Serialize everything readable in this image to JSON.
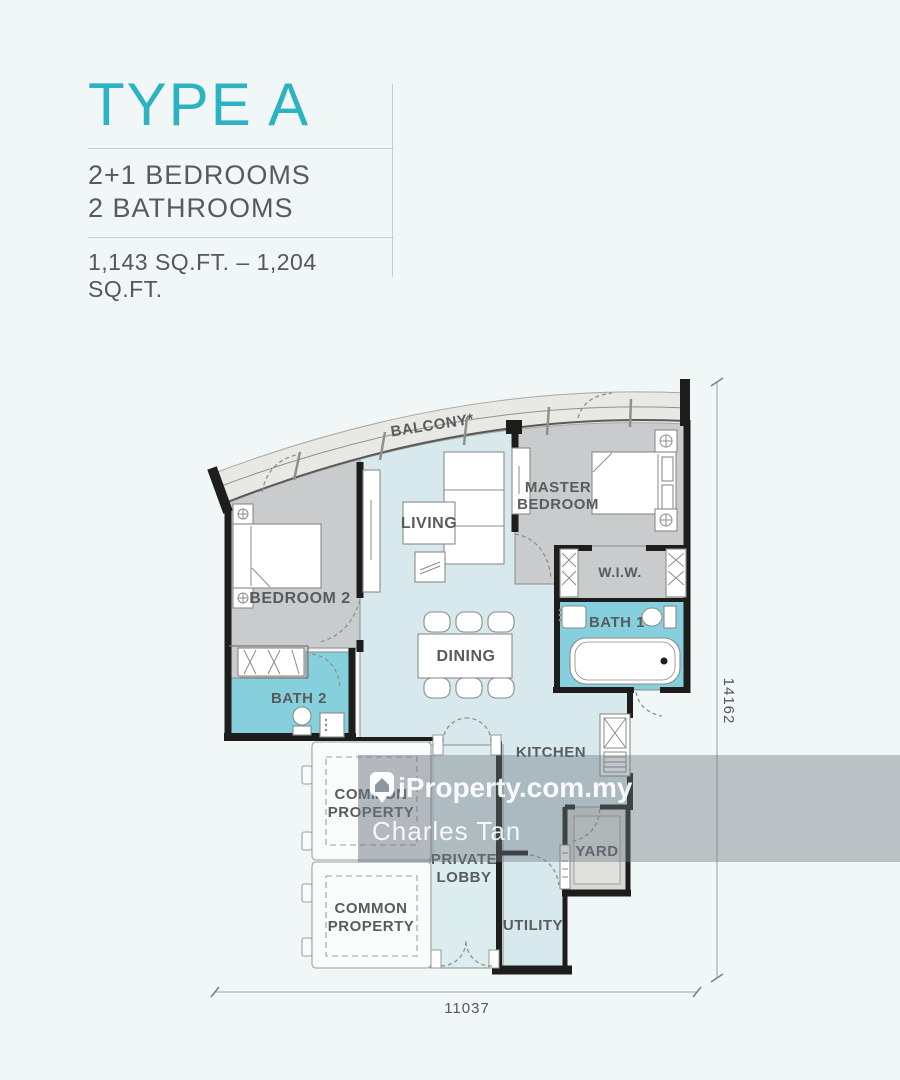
{
  "header": {
    "title": "TYPE A",
    "bedrooms": "2+1 BEDROOMS",
    "bathrooms": "2 BATHROOMS",
    "area": "1,143 SQ.FT. – 1,204 SQ.FT."
  },
  "floorplan": {
    "labels": {
      "balcony": "BALCONY*",
      "living": "LIVING",
      "master_line1": "MASTER",
      "master_line2": "BEDROOM",
      "bedroom2": "BEDROOM 2",
      "wiw": "W.I.W.",
      "bath1": "BATH 1",
      "bath2": "BATH 2",
      "dining": "DINING",
      "kitchen": "KITCHEN",
      "yard": "YARD",
      "utility": "UTILITY",
      "lobby_line1": "PRIVATE",
      "lobby_line2": "LOBBY",
      "common_line1": "COMMON",
      "common_line2": "PROPERTY"
    },
    "dimensions": {
      "height_label": "14162",
      "width_label": "11037"
    },
    "colors": {
      "accent": "#2bb3c3",
      "hall": "#d7e9ed",
      "bedroom": "#c9cbcd",
      "bath": "#86d0dd",
      "balcony": "#e8e8e4",
      "yard": "#d8d9d5",
      "lobby": "#dcedf0",
      "wall": "#1d1d1b",
      "watermark_band": "#6d7982"
    }
  },
  "watermark": {
    "brand": "iProperty.com.my",
    "agent": "Charles Tan"
  }
}
